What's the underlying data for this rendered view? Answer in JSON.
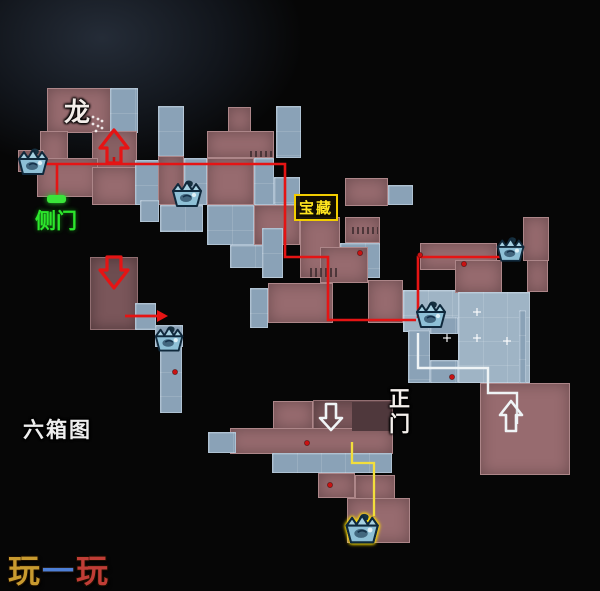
{
  "labels": {
    "dragon": "龙",
    "side_door": "侧门",
    "treasure": "宝藏",
    "main_gate": "正\n门",
    "six_box_map": "六箱图"
  },
  "logo": {
    "char1": "玩",
    "char2": "一",
    "char3": "玩",
    "color1": "#c89a2f",
    "color2": "#4d7fd6",
    "color3": "#c03d36"
  },
  "map": {
    "colors": {
      "background": "#060606",
      "room_red": "#976b6f",
      "room_red_dark": "#7a565a",
      "room_blue": "#8aa2b7",
      "room_blue_light": "#9fb4c5",
      "route_red": "#e51414",
      "route_white": "#eff4f6",
      "route_yellow": "#f2de3c",
      "door_green": "#3ae43a",
      "chest_fill": "#8ec0d6",
      "chest_outline": "#10293c",
      "chest_glow": "#ffe000",
      "dot_red": "#c81212"
    },
    "rooms": [
      [
        47,
        88,
        64,
        45,
        "r"
      ],
      [
        110,
        88,
        28,
        45,
        "b"
      ],
      [
        40,
        131,
        28,
        42,
        "r"
      ],
      [
        92,
        131,
        45,
        41,
        "r"
      ],
      [
        37,
        158,
        61,
        39,
        "r"
      ],
      [
        92,
        167,
        46,
        38,
        "r"
      ],
      [
        135,
        160,
        24,
        45,
        "b"
      ],
      [
        158,
        106,
        26,
        52,
        "b"
      ],
      [
        158,
        156,
        26,
        49,
        "r"
      ],
      [
        184,
        158,
        23,
        47,
        "b"
      ],
      [
        160,
        205,
        43,
        27,
        "b"
      ],
      [
        140,
        200,
        19,
        22,
        "b"
      ],
      [
        228,
        107,
        23,
        25,
        "r"
      ],
      [
        207,
        131,
        67,
        27,
        "r"
      ],
      [
        276,
        106,
        25,
        52,
        "b"
      ],
      [
        207,
        158,
        47,
        47,
        "r"
      ],
      [
        254,
        158,
        20,
        47,
        "b"
      ],
      [
        274,
        177,
        26,
        28,
        "b"
      ],
      [
        207,
        205,
        47,
        40,
        "b"
      ],
      [
        254,
        205,
        46,
        40,
        "r"
      ],
      [
        230,
        245,
        46,
        23,
        "b"
      ],
      [
        262,
        228,
        21,
        50,
        "b"
      ],
      [
        250,
        288,
        18,
        40,
        "b"
      ],
      [
        268,
        283,
        65,
        40,
        "r"
      ],
      [
        345,
        178,
        43,
        28,
        "r"
      ],
      [
        388,
        185,
        25,
        20,
        "b"
      ],
      [
        300,
        217,
        40,
        61,
        "r"
      ],
      [
        345,
        217,
        35,
        26,
        "r"
      ],
      [
        340,
        243,
        40,
        35,
        "b"
      ],
      [
        320,
        247,
        48,
        36,
        "r"
      ],
      [
        368,
        280,
        35,
        43,
        "r"
      ],
      [
        403,
        290,
        57,
        42,
        "bl"
      ],
      [
        420,
        243,
        77,
        27,
        "r"
      ],
      [
        455,
        260,
        47,
        33,
        "r"
      ],
      [
        527,
        260,
        21,
        32,
        "r"
      ],
      [
        523,
        217,
        26,
        44,
        "r"
      ],
      [
        458,
        292,
        72,
        91,
        "bl"
      ],
      [
        430,
        317,
        28,
        17,
        "b"
      ],
      [
        519,
        310,
        7,
        73,
        "b"
      ],
      [
        480,
        383,
        90,
        92,
        "r"
      ],
      [
        90,
        257,
        48,
        73,
        "rd"
      ],
      [
        135,
        303,
        21,
        27,
        "b"
      ],
      [
        155,
        325,
        28,
        22,
        "b"
      ],
      [
        160,
        347,
        22,
        66,
        "b"
      ],
      [
        408,
        330,
        22,
        53,
        "b"
      ],
      [
        430,
        360,
        28,
        23,
        "b"
      ],
      [
        313,
        400,
        80,
        33,
        "rd"
      ],
      [
        273,
        401,
        40,
        28,
        "r"
      ],
      [
        230,
        428,
        163,
        26,
        "r"
      ],
      [
        208,
        432,
        28,
        21,
        "b"
      ],
      [
        272,
        453,
        120,
        20,
        "b"
      ],
      [
        318,
        473,
        37,
        25,
        "r"
      ],
      [
        355,
        475,
        40,
        25,
        "r"
      ],
      [
        347,
        498,
        63,
        45,
        "r"
      ],
      [
        18,
        150,
        26,
        22,
        "r"
      ]
    ],
    "inner_rects": [
      [
        352,
        402,
        40,
        29,
        "#4f383c"
      ]
    ],
    "grills": [
      [
        310,
        268,
        28,
        9
      ],
      [
        352,
        227,
        26,
        7
      ],
      [
        250,
        151,
        22,
        6
      ]
    ],
    "routes": {
      "red_main": "30,164 285,164 285,257 328,257 328,320 416,320",
      "red_link": "418,318 418,257 500,257",
      "red_door_branch": "57,164 57,198",
      "red_arrow_stem": "114,164 114,157",
      "red_side": "125,316 159,316",
      "white_route": "418,333 418,368 488,368 488,393 517,393 517,424",
      "yellow_route": "352,442 352,463 374,463 374,516"
    },
    "red_arrowhead": "157,310 168,316 157,322",
    "arrows": [
      {
        "name": "red-up-arrow",
        "points": "114,130 128,148 121,148 121,163 107,163 107,148 100,148",
        "color": "#e51414"
      },
      {
        "name": "red-down-arrow",
        "points": "114,288 100,270 107,270 107,257 121,257 121,270 128,270",
        "color": "#e51414"
      },
      {
        "name": "white-down-arrow",
        "points": "331,430 320,418 326,418 326,404 336,404 336,418 342,418",
        "color": "#eff4f6"
      },
      {
        "name": "white-up-arrow",
        "points": "511,401 522,415 516,415 516,431 506,431 506,415 500,415",
        "color": "#eff4f6"
      }
    ],
    "door": {
      "x": 47,
      "y": 195,
      "w": 19,
      "h": 8
    },
    "chests": [
      {
        "x": 15,
        "y": 146,
        "s": 1.0,
        "glow": false
      },
      {
        "x": 169,
        "y": 178,
        "s": 1.0,
        "glow": false
      },
      {
        "x": 152,
        "y": 324,
        "s": 0.95,
        "glow": false
      },
      {
        "x": 494,
        "y": 235,
        "s": 0.92,
        "glow": false
      },
      {
        "x": 413,
        "y": 299,
        "s": 1.0,
        "glow": false
      },
      {
        "x": 342,
        "y": 511,
        "s": 1.12,
        "glow": true
      }
    ],
    "dots": [
      [
        360,
        253
      ],
      [
        420,
        255
      ],
      [
        464,
        264
      ],
      [
        452,
        377
      ],
      [
        307,
        443
      ],
      [
        330,
        485
      ],
      [
        175,
        372
      ]
    ],
    "crosses": [
      [
        477,
        312
      ],
      [
        447,
        338
      ],
      [
        477,
        338
      ],
      [
        507,
        341
      ]
    ],
    "stair_dots": [
      [
        93,
        117
      ],
      [
        98,
        119
      ],
      [
        102,
        121
      ],
      [
        93,
        124
      ],
      [
        98,
        126
      ],
      [
        102,
        128
      ],
      [
        96,
        131
      ]
    ]
  }
}
